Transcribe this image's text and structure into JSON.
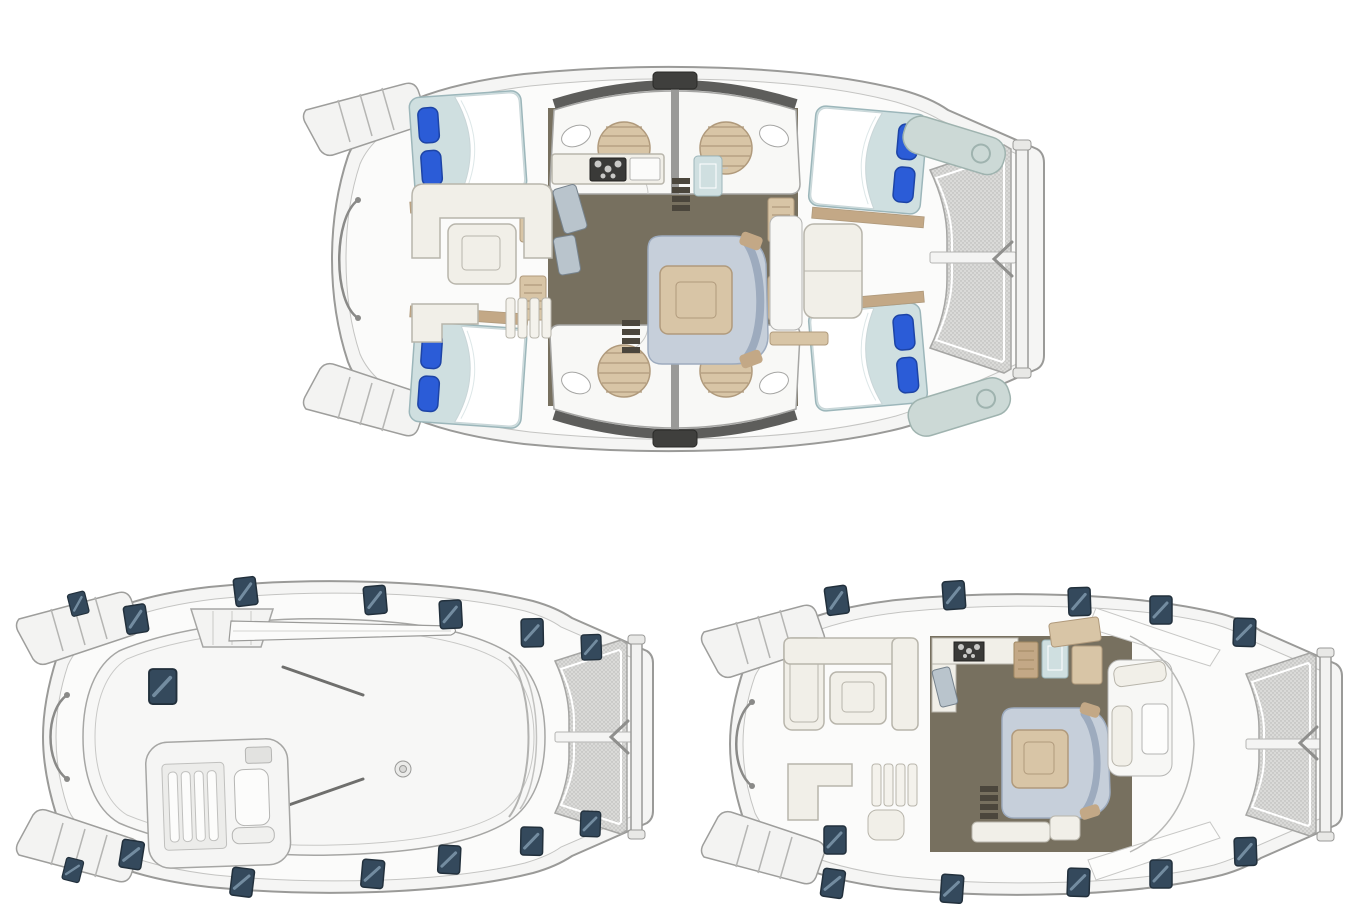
{
  "canvas": {
    "width_px": 1363,
    "height_px": 909,
    "background": "#ffffff"
  },
  "figure": {
    "type": "catamaran-deck-plans",
    "views": [
      {
        "id": "lower-deck-plan",
        "position": "top-center",
        "double_berths": 4,
        "berth_pillows": 8,
        "shower_rooms": 4,
        "shower_grates": 4,
        "wash_basins": 4,
        "salon_sofa": 1,
        "cockpit_sofa": 1,
        "tables": 2,
        "companionway_ladders": 2,
        "bow_lockers": 2,
        "trampoline": true
      },
      {
        "id": "exterior-top-view",
        "position": "bottom-left",
        "deck_hatches": 15,
        "helm_station": true,
        "boom": true,
        "traveler_arch": true,
        "winches": 1,
        "trampoline": true
      },
      {
        "id": "main-deck-plan",
        "position": "bottom-right",
        "deck_hatches": 11,
        "cockpit_sofa": 1,
        "cockpit_bench": 1,
        "salon_sofa": 1,
        "forward_cockpit_seats": 2,
        "tables": 3,
        "galley_stove": true,
        "trampoline": true
      }
    ]
  },
  "colors": {
    "page_bg": "#ffffff",
    "outline": "#9a9a98",
    "outline_soft": "#c4c4c2",
    "hull_fill": "#f5f5f4",
    "deck_fill": "#fbfbfa",
    "floor": "#77705f",
    "floor_dark": "#4b463c",
    "wood": "#d8c5a6",
    "wood_dark": "#c3a886",
    "wood_line": "#b09a7c",
    "cream": "#f1efe8",
    "cream_edge": "#b8b5ab",
    "sofa": "#c6cfda",
    "sofa_dark": "#9dabbe",
    "mattress": "#cfdfe0",
    "mattress_edge": "#9cb6ba",
    "pillow": "#2b5cd7",
    "pillow_dark": "#1d44a6",
    "hatch": "#34495c",
    "hatch_light": "#7e98ad",
    "coaming": "#5d5d5b",
    "tramp": "#dadad8",
    "tramp_dot": "#b4b4b2",
    "steel": "#b9c4cc"
  }
}
